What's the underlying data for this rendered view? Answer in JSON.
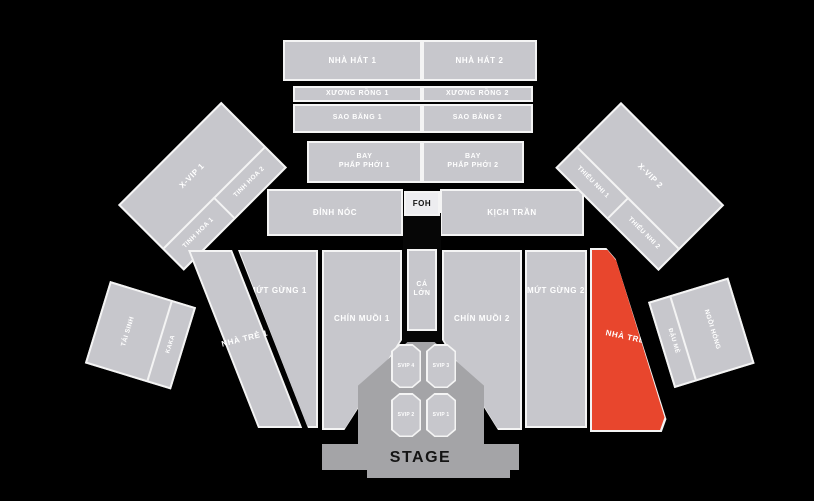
{
  "map_title": "concert-seating-map",
  "colors": {
    "background": "#000000",
    "section": "#c7c7cc",
    "section_border": "#f4f4f4",
    "highlight_zone": "#e8462d",
    "stage_gray": "#a4a4a7",
    "foh_bg": "#ededf0",
    "label_text": "#ffffff",
    "dark_text": "#141414"
  },
  "zones": {
    "nha_hat_1": "NHÀ HÁT 1",
    "nha_hat_2": "NHÀ HÁT 2",
    "xuong_rong_1": "XƯƠNG RỒNG 1",
    "xuong_rong_2": "XƯƠNG RỒNG 2",
    "sao_bang_1": "SAO BĂNG 1",
    "sao_bang_2": "SAO BĂNG 2",
    "bay_phap_phoi_1": {
      "line1": "BAY",
      "line2": "PHẤP PHỚI 1"
    },
    "bay_phap_phoi_2": {
      "line1": "BAY",
      "line2": "PHẤP PHỚI 2"
    },
    "dinh_noc": "ĐỈNH NÓC",
    "kich_tran": "KỊCH TRẦN",
    "foh": "FOH",
    "x_vip_1": "X-VIP 1",
    "tinh_hoa_1": "TINH HOA 1",
    "tinh_hoa_2": "TINH HOA 2",
    "x_vip_2": "X-VIP 2",
    "thieu_nhi_1": "THIẾU NHI 1",
    "thieu_nhi_2": "THIẾU NHI 2",
    "nha_tre_1": "NHÀ TRẺ 1",
    "mut_gung_1": "MỨT GỪNG 1",
    "chin_muoi_1": "CHÍN MUỒI 1",
    "ca_lon": "CÁ LỚN",
    "chin_muoi_2": "CHÍN MUỒI 2",
    "mut_gung_2": "MỨT GỪNG 2",
    "nha_tre_2": "NHÀ TRẺ 2",
    "tai_sinh": "TÁI SINH",
    "kaka": "KAKA",
    "dau_me": "ĐẬU MÈ",
    "ngoi_hong": "NGỒI HÓNG",
    "svip_1": "SVIP 1",
    "svip_2": "SVIP 2",
    "svip_3": "SVIP 3",
    "svip_4": "SVIP 4",
    "stage": "STAGE"
  }
}
